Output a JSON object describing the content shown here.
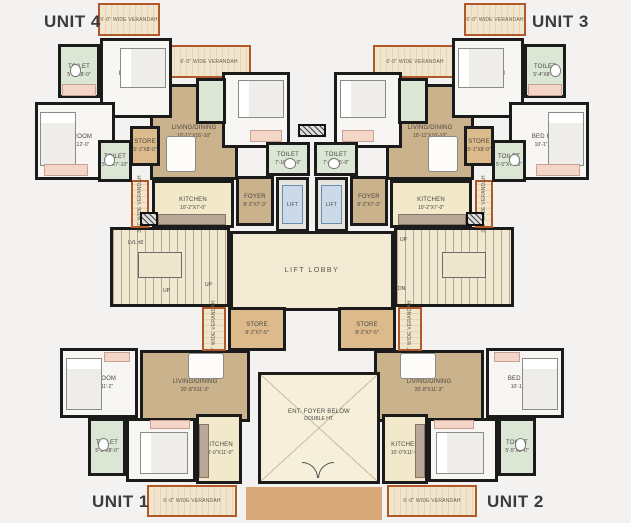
{
  "title": "Typical Floor Plan",
  "colors": {
    "wall": "#1b1b1b",
    "veranda_border": "#b2592a",
    "living_tan": "#c9b28c",
    "toilet_green": "#dbe7d4",
    "kitchen_cream": "#f2e8ca",
    "store_tan": "#dcba8c",
    "lift_blue": "#ccd9e8",
    "wardrobe_pink": "#f4d6c9",
    "porch_brown": "#d9a878",
    "lobby_cream": "#f3ead3",
    "title_color": "#3b3b3d"
  },
  "units": [
    {
      "label": "UNIT 4",
      "x": 44,
      "y": 12
    },
    {
      "label": "UNIT 3",
      "x": 532,
      "y": 12
    },
    {
      "label": "UNIT 1",
      "x": 92,
      "y": 492
    },
    {
      "label": "UNIT 2",
      "x": 487,
      "y": 492
    }
  ],
  "rooms": [
    {
      "id": "porch-entry",
      "type": "porch",
      "name": "",
      "dims": "",
      "x": 246,
      "y": 487,
      "w": 136,
      "h": 33
    },
    {
      "id": "living-dining-unit4",
      "type": "living",
      "name": "LIVING/DINING",
      "dims": "10'-11\"X16'-10\"",
      "x": 150,
      "y": 84,
      "w": 88,
      "h": 96
    },
    {
      "id": "living-dining-unit3",
      "type": "living",
      "name": "LIVING/DINING",
      "dims": "10'-11\"X16'-10\"",
      "x": 386,
      "y": 84,
      "w": 88,
      "h": 96
    },
    {
      "id": "living-dining-unit1",
      "type": "living",
      "name": "LIVING/DINING",
      "dims": "20'-8\"X11'-3\"",
      "x": 140,
      "y": 350,
      "w": 110,
      "h": 72
    },
    {
      "id": "living-dining-unit2",
      "type": "living",
      "name": "LIVING/DINING",
      "dims": "20'-8\"X11'-3\"",
      "x": 374,
      "y": 350,
      "w": 110,
      "h": 72
    },
    {
      "id": "lift-lobby",
      "type": "lobby",
      "name": "LIFT LOBBY",
      "dims": "",
      "x": 230,
      "y": 231,
      "w": 164,
      "h": 80
    },
    {
      "id": "staircase-left",
      "type": "stair",
      "name": "",
      "dims": "",
      "x": 110,
      "y": 227,
      "w": 120,
      "h": 80
    },
    {
      "id": "staircase-right",
      "type": "stair",
      "name": "",
      "dims": "",
      "x": 394,
      "y": 227,
      "w": 120,
      "h": 80
    },
    {
      "id": "entrance-foyer-void",
      "type": "entfoyer",
      "name": "ENT. FOYER BELOW",
      "dims": "DOUBLE HT.",
      "x": 258,
      "y": 372,
      "w": 122,
      "h": 112
    },
    {
      "id": "veranda-unit4-top",
      "type": "veranda",
      "name": "6'-0\" WIDE VERANDAH",
      "dims": "",
      "x": 98,
      "y": 3,
      "w": 62,
      "h": 33
    },
    {
      "id": "veranda-unit4-mid",
      "type": "veranda",
      "name": "6'-0\" WIDE VERANDAH",
      "dims": "",
      "x": 167,
      "y": 45,
      "w": 84,
      "h": 33
    },
    {
      "id": "veranda-unit3-top",
      "type": "veranda",
      "name": "6'-0\" WIDE VERANDAH",
      "dims": "",
      "x": 464,
      "y": 3,
      "w": 62,
      "h": 33
    },
    {
      "id": "veranda-unit3-mid",
      "type": "veranda",
      "name": "6'-0\" WIDE VERANDAH",
      "dims": "",
      "x": 373,
      "y": 45,
      "w": 84,
      "h": 33
    },
    {
      "id": "veranda-unit4-kitchen",
      "type": "veranda",
      "vert": true,
      "name": "3'-0\" WIDE VERANDAH",
      "dims": "",
      "x": 131,
      "y": 180,
      "w": 18,
      "h": 48
    },
    {
      "id": "veranda-unit3-kitchen",
      "type": "veranda",
      "vert": true,
      "name": "3'-0\" WIDE VERANDAH",
      "dims": "",
      "x": 475,
      "y": 180,
      "w": 18,
      "h": 48
    },
    {
      "id": "veranda-store-left",
      "type": "veranda",
      "vert": true,
      "name": "4'-2\" WIDE VERANDAH",
      "dims": "",
      "x": 202,
      "y": 307,
      "w": 24,
      "h": 44
    },
    {
      "id": "veranda-store-right",
      "type": "veranda",
      "vert": true,
      "name": "4'-2\" WIDE VERANDAH",
      "dims": "",
      "x": 398,
      "y": 307,
      "w": 24,
      "h": 44
    },
    {
      "id": "veranda-unit1",
      "type": "veranda",
      "name": "6'-0\" WIDE VERANDAH",
      "dims": "",
      "x": 147,
      "y": 485,
      "w": 90,
      "h": 32
    },
    {
      "id": "veranda-unit2",
      "type": "veranda",
      "name": "6'-0\" WIDE VERANDAH",
      "dims": "",
      "x": 387,
      "y": 485,
      "w": 90,
      "h": 32
    },
    {
      "id": "store-unit4",
      "type": "store",
      "name": "STORE",
      "dims": "5'-1\"X8'-0\"",
      "x": 130,
      "y": 126,
      "w": 30,
      "h": 40
    },
    {
      "id": "store-unit3",
      "type": "store",
      "name": "STORE",
      "dims": "5'-1\"X8'-0\"",
      "x": 464,
      "y": 126,
      "w": 30,
      "h": 40
    },
    {
      "id": "store-lobby-left",
      "type": "store",
      "name": "STORE",
      "dims": "8'-2\"X7'-5\"",
      "x": 228,
      "y": 307,
      "w": 58,
      "h": 44
    },
    {
      "id": "store-lobby-right",
      "type": "store",
      "name": "STORE",
      "dims": "8'-2\"X7'-5\"",
      "x": 338,
      "y": 307,
      "w": 58,
      "h": 44
    },
    {
      "id": "kitchen-unit4",
      "type": "kitchen",
      "name": "KITCHEN",
      "dims": "10'-2\"X7'-0\"",
      "x": 152,
      "y": 180,
      "w": 82,
      "h": 48
    },
    {
      "id": "kitchen-unit3",
      "type": "kitchen",
      "name": "KITCHEN",
      "dims": "10'-2\"X7'-0\"",
      "x": 390,
      "y": 180,
      "w": 82,
      "h": 48
    },
    {
      "id": "kitchen-unit1",
      "type": "kitchen",
      "name": "KITCHEN",
      "dims": "10'-0\"X11'-0\"",
      "x": 196,
      "y": 414,
      "w": 46,
      "h": 70
    },
    {
      "id": "kitchen-unit2",
      "type": "kitchen",
      "name": "KITCHEN",
      "dims": "10'-0\"X11'-0\"",
      "x": 382,
      "y": 414,
      "w": 46,
      "h": 70
    },
    {
      "id": "foyer-unit4",
      "type": "foyer",
      "name": "FOYER",
      "dims": "8'-2\"X7'-3\"",
      "x": 236,
      "y": 176,
      "w": 38,
      "h": 50
    },
    {
      "id": "foyer-unit3",
      "type": "foyer",
      "name": "FOYER",
      "dims": "8'-2\"X7'-3\"",
      "x": 350,
      "y": 176,
      "w": 38,
      "h": 50
    },
    {
      "id": "bedroom-unit4-top",
      "type": "bedroom",
      "name": "BED ROOM",
      "dims": "10'-10\"X11'-0\"",
      "x": 100,
      "y": 38,
      "w": 72,
      "h": 80
    },
    {
      "id": "bedroom-unit4-left",
      "type": "bedroom",
      "name": "BED ROOM",
      "dims": "10'-1\"X12'-0\"",
      "x": 35,
      "y": 102,
      "w": 80,
      "h": 78
    },
    {
      "id": "bedroom-unit4-center",
      "type": "bedroom",
      "name": "BED ROOM",
      "dims": "10'-0\"X10'-0\"",
      "x": 222,
      "y": 72,
      "w": 68,
      "h": 76
    },
    {
      "id": "bedroom-unit3-top",
      "type": "bedroom",
      "name": "BED ROOM",
      "dims": "10'-10\"X11'-0\"",
      "x": 452,
      "y": 38,
      "w": 72,
      "h": 80
    },
    {
      "id": "bedroom-unit3-right",
      "type": "bedroom",
      "name": "BED ROOM",
      "dims": "10'-1\"X12'-0\"",
      "x": 509,
      "y": 102,
      "w": 80,
      "h": 78
    },
    {
      "id": "bedroom-unit3-center",
      "type": "bedroom",
      "name": "BED ROOM",
      "dims": "10'-0\"X10'-0\"",
      "x": 334,
      "y": 72,
      "w": 68,
      "h": 76
    },
    {
      "id": "bedroom-unit1-left",
      "type": "bedroom",
      "name": "BED ROOM",
      "dims": "10'-1\"X11'-2\"",
      "x": 60,
      "y": 348,
      "w": 78,
      "h": 70
    },
    {
      "id": "bedroom-unit1-bottom",
      "type": "bedroom",
      "name": "BEDROOM",
      "dims": "11'-1\"X11'-0\"",
      "x": 126,
      "y": 418,
      "w": 70,
      "h": 64
    },
    {
      "id": "bedroom-unit2-right",
      "type": "bedroom",
      "name": "BED ROOM",
      "dims": "10'-1\"X11'-2\"",
      "x": 486,
      "y": 348,
      "w": 78,
      "h": 70
    },
    {
      "id": "bedroom-unit2-bottom",
      "type": "bedroom",
      "name": "BEDROOM",
      "dims": "11'-1\"X11'-0\"",
      "x": 428,
      "y": 418,
      "w": 70,
      "h": 64
    },
    {
      "id": "toilet-unit4-top",
      "type": "toilet",
      "name": "TOILET",
      "dims": "5'-4\"X8'-0\"",
      "x": 58,
      "y": 44,
      "w": 42,
      "h": 54
    },
    {
      "id": "toilet-unit4-mid",
      "type": "toilet",
      "name": "TOILET",
      "dims": "5'-5\"X7'-10\"",
      "x": 98,
      "y": 140,
      "w": 34,
      "h": 42
    },
    {
      "id": "toilet-unit4-small",
      "type": "toilet",
      "name": "",
      "dims": "",
      "x": 196,
      "y": 78,
      "w": 30,
      "h": 46
    },
    {
      "id": "toilet-unit4-lift",
      "type": "toilet",
      "name": "TOILET",
      "dims": "7'-10\"X5'-0\"",
      "x": 266,
      "y": 142,
      "w": 44,
      "h": 34
    },
    {
      "id": "toilet-unit3-top",
      "type": "toilet",
      "name": "TOILET",
      "dims": "5'-4\"X8'-0\"",
      "x": 524,
      "y": 44,
      "w": 42,
      "h": 54
    },
    {
      "id": "toilet-unit3-mid",
      "type": "toilet",
      "name": "TOILET",
      "dims": "5'-5\"X7'-10\"",
      "x": 492,
      "y": 140,
      "w": 34,
      "h": 42
    },
    {
      "id": "toilet-unit3-small",
      "type": "toilet",
      "name": "",
      "dims": "",
      "x": 398,
      "y": 78,
      "w": 30,
      "h": 46
    },
    {
      "id": "toilet-unit3-lift",
      "type": "toilet",
      "name": "TOILET",
      "dims": "7'-10\"X5'-0\"",
      "x": 314,
      "y": 142,
      "w": 44,
      "h": 34
    },
    {
      "id": "toilet-unit1",
      "type": "toilet",
      "name": "TOILET",
      "dims": "5'-5\"X8'-0\"",
      "x": 88,
      "y": 418,
      "w": 38,
      "h": 58
    },
    {
      "id": "toilet-unit2",
      "type": "toilet",
      "name": "TOILET",
      "dims": "5'-5\"X8'-0\"",
      "x": 498,
      "y": 418,
      "w": 38,
      "h": 58
    },
    {
      "id": "lift-1",
      "type": "lift",
      "name": "LIFT",
      "dims": "",
      "x": 276,
      "y": 177,
      "w": 33,
      "h": 55
    },
    {
      "id": "lift-2",
      "type": "lift",
      "name": "LIFT",
      "dims": "",
      "x": 315,
      "y": 177,
      "w": 33,
      "h": 55
    }
  ],
  "furniture": [
    {
      "t": "bed-h",
      "x": 120,
      "y": 48,
      "w": 46,
      "h": 40
    },
    {
      "t": "bed-v",
      "x": 40,
      "y": 112,
      "w": 36,
      "h": 54
    },
    {
      "t": "bed-h",
      "x": 238,
      "y": 80,
      "w": 46,
      "h": 38
    },
    {
      "t": "bed-h",
      "x": 458,
      "y": 48,
      "w": 46,
      "h": 40
    },
    {
      "t": "bed-v",
      "x": 548,
      "y": 112,
      "w": 36,
      "h": 54
    },
    {
      "t": "bed-h",
      "x": 340,
      "y": 80,
      "w": 46,
      "h": 38
    },
    {
      "t": "bed-v",
      "x": 66,
      "y": 358,
      "w": 36,
      "h": 52
    },
    {
      "t": "bed-h",
      "x": 140,
      "y": 432,
      "w": 48,
      "h": 42
    },
    {
      "t": "bed-v",
      "x": 522,
      "y": 358,
      "w": 36,
      "h": 52
    },
    {
      "t": "bed-h",
      "x": 436,
      "y": 432,
      "w": 48,
      "h": 42
    },
    {
      "t": "table",
      "x": 166,
      "y": 136,
      "w": 30,
      "h": 36
    },
    {
      "t": "table",
      "x": 428,
      "y": 136,
      "w": 30,
      "h": 36
    },
    {
      "t": "table",
      "x": 188,
      "y": 353,
      "w": 36,
      "h": 26
    },
    {
      "t": "table",
      "x": 400,
      "y": 353,
      "w": 36,
      "h": 26
    },
    {
      "t": "landing",
      "x": 138,
      "y": 252,
      "w": 44,
      "h": 26
    },
    {
      "t": "landing",
      "x": 442,
      "y": 252,
      "w": 44,
      "h": 26
    },
    {
      "t": "counter",
      "x": 158,
      "y": 214,
      "w": 68,
      "h": 11
    },
    {
      "t": "counter",
      "x": 398,
      "y": 214,
      "w": 68,
      "h": 11
    },
    {
      "t": "counter",
      "x": 199,
      "y": 424,
      "w": 10,
      "h": 54
    },
    {
      "t": "counter",
      "x": 415,
      "y": 424,
      "w": 10,
      "h": 54
    },
    {
      "t": "wardrobe",
      "x": 62,
      "y": 84,
      "w": 34,
      "h": 12
    },
    {
      "t": "wardrobe",
      "x": 44,
      "y": 164,
      "w": 44,
      "h": 12
    },
    {
      "t": "wardrobe",
      "x": 250,
      "y": 130,
      "w": 32,
      "h": 12
    },
    {
      "t": "wardrobe",
      "x": 528,
      "y": 84,
      "w": 34,
      "h": 12
    },
    {
      "t": "wardrobe",
      "x": 536,
      "y": 164,
      "w": 44,
      "h": 12
    },
    {
      "t": "wardrobe",
      "x": 342,
      "y": 130,
      "w": 32,
      "h": 12
    },
    {
      "t": "wardrobe",
      "x": 104,
      "y": 352,
      "w": 26,
      "h": 10
    },
    {
      "t": "wardrobe",
      "x": 150,
      "y": 420,
      "w": 40,
      "h": 9
    },
    {
      "t": "wardrobe",
      "x": 494,
      "y": 352,
      "w": 26,
      "h": 10
    },
    {
      "t": "wardrobe",
      "x": 434,
      "y": 420,
      "w": 40,
      "h": 9
    },
    {
      "t": "wc",
      "x": 70,
      "y": 64,
      "w": 11,
      "h": 13
    },
    {
      "t": "wc",
      "x": 104,
      "y": 154,
      "w": 11,
      "h": 12
    },
    {
      "t": "wc",
      "x": 284,
      "y": 158,
      "w": 12,
      "h": 11
    },
    {
      "t": "wc",
      "x": 550,
      "y": 64,
      "w": 11,
      "h": 13
    },
    {
      "t": "wc",
      "x": 509,
      "y": 154,
      "w": 11,
      "h": 12
    },
    {
      "t": "wc",
      "x": 328,
      "y": 158,
      "w": 12,
      "h": 11
    },
    {
      "t": "wc",
      "x": 98,
      "y": 438,
      "w": 11,
      "h": 13
    },
    {
      "t": "wc",
      "x": 515,
      "y": 438,
      "w": 11,
      "h": 13
    },
    {
      "t": "shaft",
      "x": 140,
      "y": 212,
      "w": 18,
      "h": 14
    },
    {
      "t": "shaft",
      "x": 466,
      "y": 212,
      "w": 18,
      "h": 14
    },
    {
      "t": "shaft",
      "x": 298,
      "y": 124,
      "w": 28,
      "h": 13
    },
    {
      "t": "door-left",
      "x": 302,
      "y": 462,
      "w": 16,
      "h": 16
    },
    {
      "t": "door-right",
      "x": 318,
      "y": 462,
      "w": 16,
      "h": 16
    }
  ],
  "labels": [
    {
      "text": "LVL ±0",
      "x": 128,
      "y": 240
    },
    {
      "text": "UP",
      "x": 163,
      "y": 288
    },
    {
      "text": "UP",
      "x": 205,
      "y": 282
    },
    {
      "text": "UP",
      "x": 400,
      "y": 237
    },
    {
      "text": "DN",
      "x": 398,
      "y": 286
    }
  ]
}
